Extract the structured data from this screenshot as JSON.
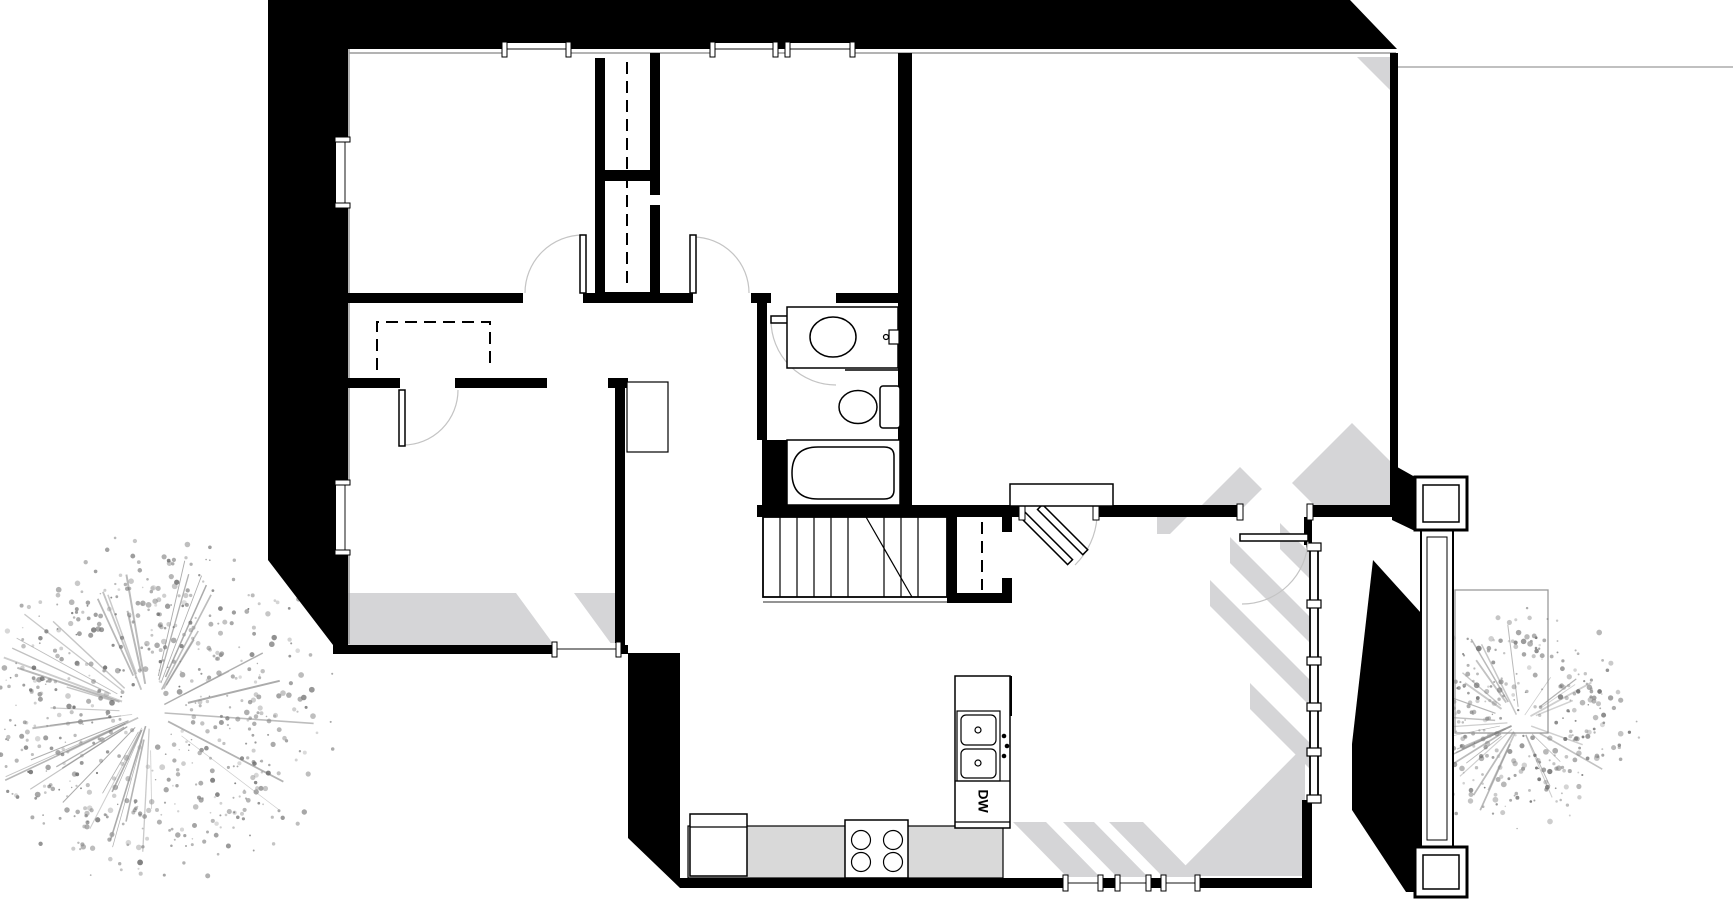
{
  "image": {
    "type": "architectural-floor-plan"
  },
  "labels": {
    "dishwasher": "DW"
  },
  "fixtures": [
    "bathtub",
    "toilet",
    "bathroom-sink",
    "kitchen-sink",
    "dishwasher",
    "cooktop-4-burner",
    "staircase",
    "closet-rod-dashed",
    "door-swing",
    "window",
    "porch-column",
    "entry-stoop",
    "tree"
  ],
  "colors": {
    "wall": "#000000",
    "shadow": "#d5d5d7",
    "counter": "#d9d9d9",
    "glass_line": "#8a8a8a",
    "site_line": "#9a9a9a",
    "foliage": "#8a8a8a",
    "background": "#ffffff"
  }
}
